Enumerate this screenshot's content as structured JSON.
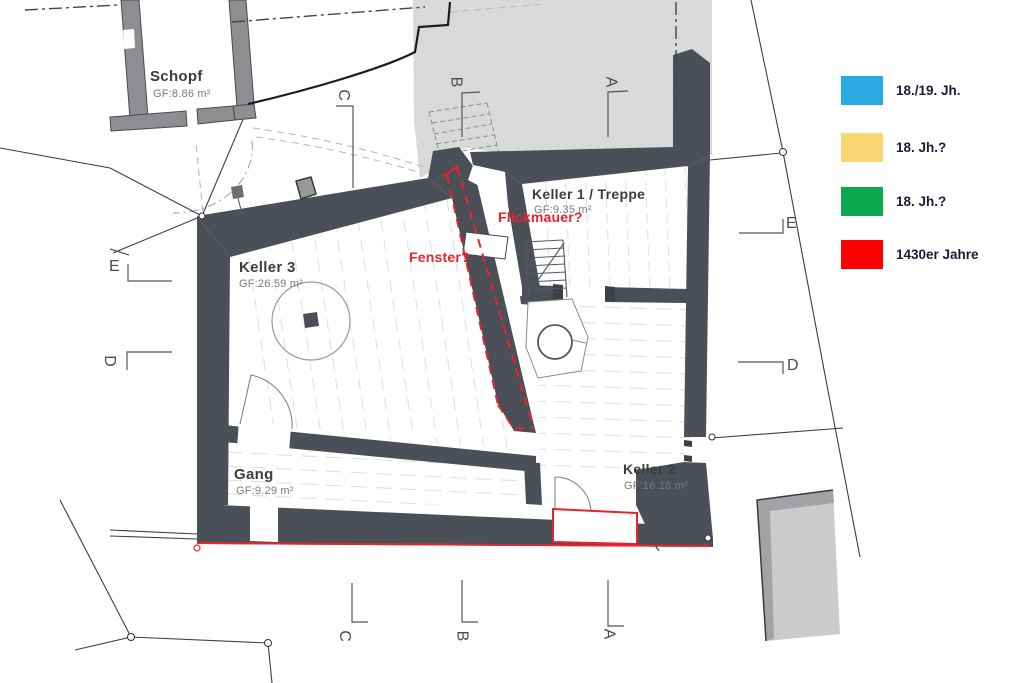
{
  "title": "Kellergeschoss Bauphasenplan",
  "rooms": [
    {
      "name": "Schopf",
      "area": "GF:8.86 m²"
    },
    {
      "name": "Keller 3",
      "area": "GF:26.59 m²"
    },
    {
      "name": "Keller 1 / Treppe",
      "area": "GF:9.35 m²"
    },
    {
      "name": "Gang",
      "area": "GF:9.29 m²"
    },
    {
      "name": "Keller 2",
      "area": "GF:16.18 m²"
    }
  ],
  "annotations": [
    {
      "text": "Flickmauer?"
    },
    {
      "text": "Fenster?"
    }
  ],
  "markers": {
    "top": [
      "C",
      "B",
      "A"
    ],
    "bottom": [
      "C",
      "B",
      "A"
    ],
    "left": [
      "E",
      "D"
    ],
    "right": [
      "E",
      "D"
    ]
  },
  "legend": {
    "items": [
      {
        "label": "18./19. Jh.",
        "color": "#29abe2"
      },
      {
        "label": "18. Jh.?",
        "color": "#fcd573"
      },
      {
        "label": "18. Jh.?",
        "color": "#0ca84f"
      },
      {
        "label": "1430er Jahre",
        "color": "#fe0000"
      }
    ]
  },
  "colors": {
    "wall": "#4b4f58",
    "street": "#d9d9d9",
    "outwall": "#8d8e92",
    "red": "#e8232a"
  }
}
